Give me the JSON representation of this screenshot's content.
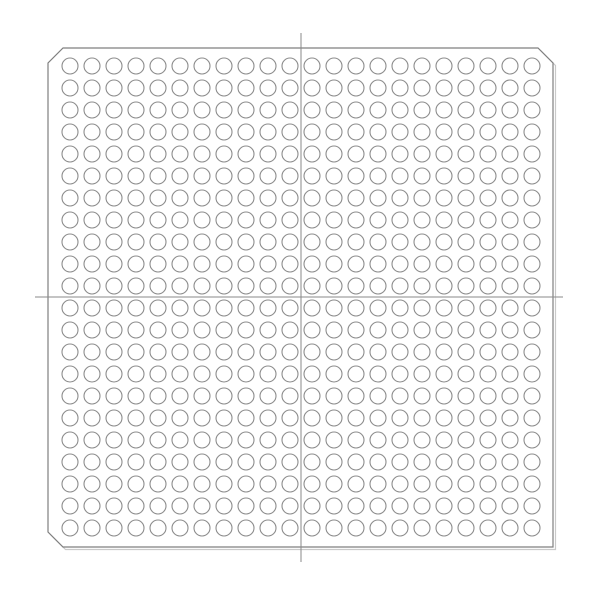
{
  "diagram": {
    "kind": "bga-package-footprint",
    "canvas": {
      "width": 600,
      "height": 600,
      "background": "#ffffff"
    },
    "package": {
      "left": 48,
      "top": 48,
      "right": 553,
      "bottom": 547,
      "chamfer": 15,
      "chamfered_corners": [
        "top-left",
        "top-right",
        "bottom-left"
      ],
      "square_corners": [
        "bottom-right"
      ],
      "outline_color": "#7f7f7f",
      "outline_width": 1.2,
      "shadow_color": "#c9c9c9",
      "shadow_offset": 2.5,
      "fill": "#ffffff"
    },
    "ball_grid": {
      "rows": 22,
      "columns": 22,
      "pitch_x": 22,
      "pitch_y": 22,
      "first_center_x": 70,
      "first_center_y": 66,
      "ball_diameter": 16,
      "ball_stroke_color": "#8c8c8c",
      "ball_stroke_width": 1.1,
      "ball_fill": "#ffffff",
      "total_balls": 484
    },
    "crosshair": {
      "color": "#8a8a8a",
      "width": 1,
      "vertical": {
        "x": 301,
        "y1": 33,
        "y2": 562
      },
      "horizontal": {
        "y": 297,
        "x1": 35,
        "x2": 563
      }
    }
  }
}
